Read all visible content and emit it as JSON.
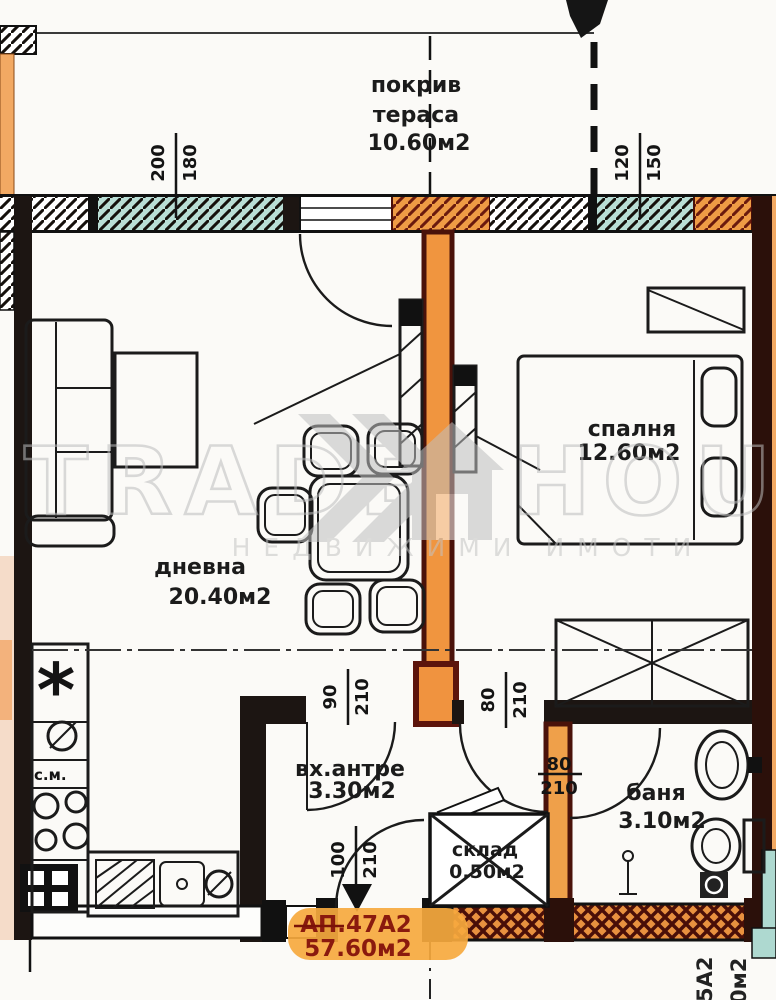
{
  "rooms": {
    "terrace": {
      "line1": "покрив",
      "line2": "тераса",
      "area": "10.60м2"
    },
    "living": {
      "name": "дневна",
      "area": "20.40м2"
    },
    "bedroom": {
      "name": "спалня",
      "area": "12.60м2"
    },
    "hall": {
      "name": "вх.антре",
      "area": "3.30м2"
    },
    "storage": {
      "name": "склад",
      "area": "0.50м2"
    },
    "bath": {
      "name": "баня",
      "area": "3.10м2"
    }
  },
  "apartment": {
    "id": "АП.47А2",
    "area": "57.60м2"
  },
  "neighbor": {
    "id": "5А2",
    "area": "0м2"
  },
  "kitchen": {
    "washer_label": "с.м.",
    "fridge_symbol": "*"
  },
  "dimensions": {
    "terrace_left": {
      "w": "200",
      "h": "180"
    },
    "terrace_right": {
      "w": "120",
      "h": "150"
    },
    "hall_door": {
      "w": "90",
      "h": "210"
    },
    "bedroom_door": {
      "w": "80",
      "h": "210"
    },
    "bath_door": {
      "w": "80",
      "h": "210"
    },
    "entry_door": {
      "w": "100",
      "h": "210"
    }
  },
  "watermark": {
    "brand_left": "TRADE",
    "brand_right": "HOUSE",
    "tagline": "НЕДВИЖИМИ ИМОТИ"
  },
  "colors": {
    "wall": "#1c1512",
    "orange": "#f0953f",
    "dark_red": "#5c150c",
    "teal": "#aed9d0",
    "highlight": "#f6a93e",
    "badge_text": "#8a1a0e",
    "watermark": "#c7c7c7"
  }
}
